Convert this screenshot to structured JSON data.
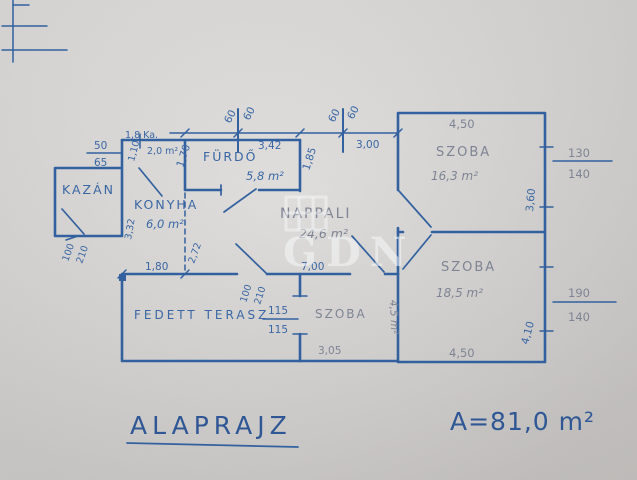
{
  "colors": {
    "paper": "#d7d5d3",
    "ink": "#33619f",
    "pencil": "#7e8494",
    "watermark": "#f5f7fa"
  },
  "watermark": {
    "text": "GDN"
  },
  "footer": {
    "title": "ALAPRAJZ",
    "total_area": "A=81,0 m²"
  },
  "rooms": {
    "kazan": {
      "label": "KAZÁN"
    },
    "kamra": {
      "label": "1,8 Ka.",
      "area": "2,0 m²"
    },
    "furdo": {
      "label": "FÜRDŐ",
      "area": "5,8 m²"
    },
    "konyha": {
      "label": "KONYHA",
      "area": "6,0 m²"
    },
    "nappali": {
      "label": "NAPPALI",
      "area": "24,6 m²"
    },
    "szoba_felso": {
      "label": "SZOBA",
      "area": "16,3 m²"
    },
    "szoba_also": {
      "label": "SZOBA",
      "area": "18,5 m²"
    },
    "szoba_kis": {
      "label": "SZOBA",
      "area": "4,5 m²"
    },
    "terasz": {
      "label": "FEDETT TERASZ"
    }
  },
  "dims": {
    "chimney1_left": "60",
    "chimney1_right": "60",
    "chimney2_left": "60",
    "chimney2_right": "60",
    "furdo_width": "3,42",
    "furdo_left_h": "1,70",
    "furdo_right_h": "1,85",
    "strip_width": "3,00",
    "window_kazan_top": "50",
    "window_kazan_bottom": "65",
    "kamra_width": "1,10",
    "kazan_door_w": "100",
    "kazan_door_h": "210",
    "konyha_height": "3,32",
    "hall_height": "2,72",
    "konyha_width": "1,80",
    "nappali_width": "7,00",
    "terasz_door_w": "100",
    "terasz_door_h": "210",
    "terasz_window_top": "115",
    "terasz_window_bottom": "115",
    "szoba_kis_width": "3,05",
    "szoba_felso_width": "4,50",
    "szoba_felso_height": "3,60",
    "window_felso_w": "130",
    "window_felso_h": "140",
    "szoba_also_width": "4,50",
    "szoba_also_height": "4,10",
    "window_also_w": "190",
    "window_also_h": "140"
  }
}
